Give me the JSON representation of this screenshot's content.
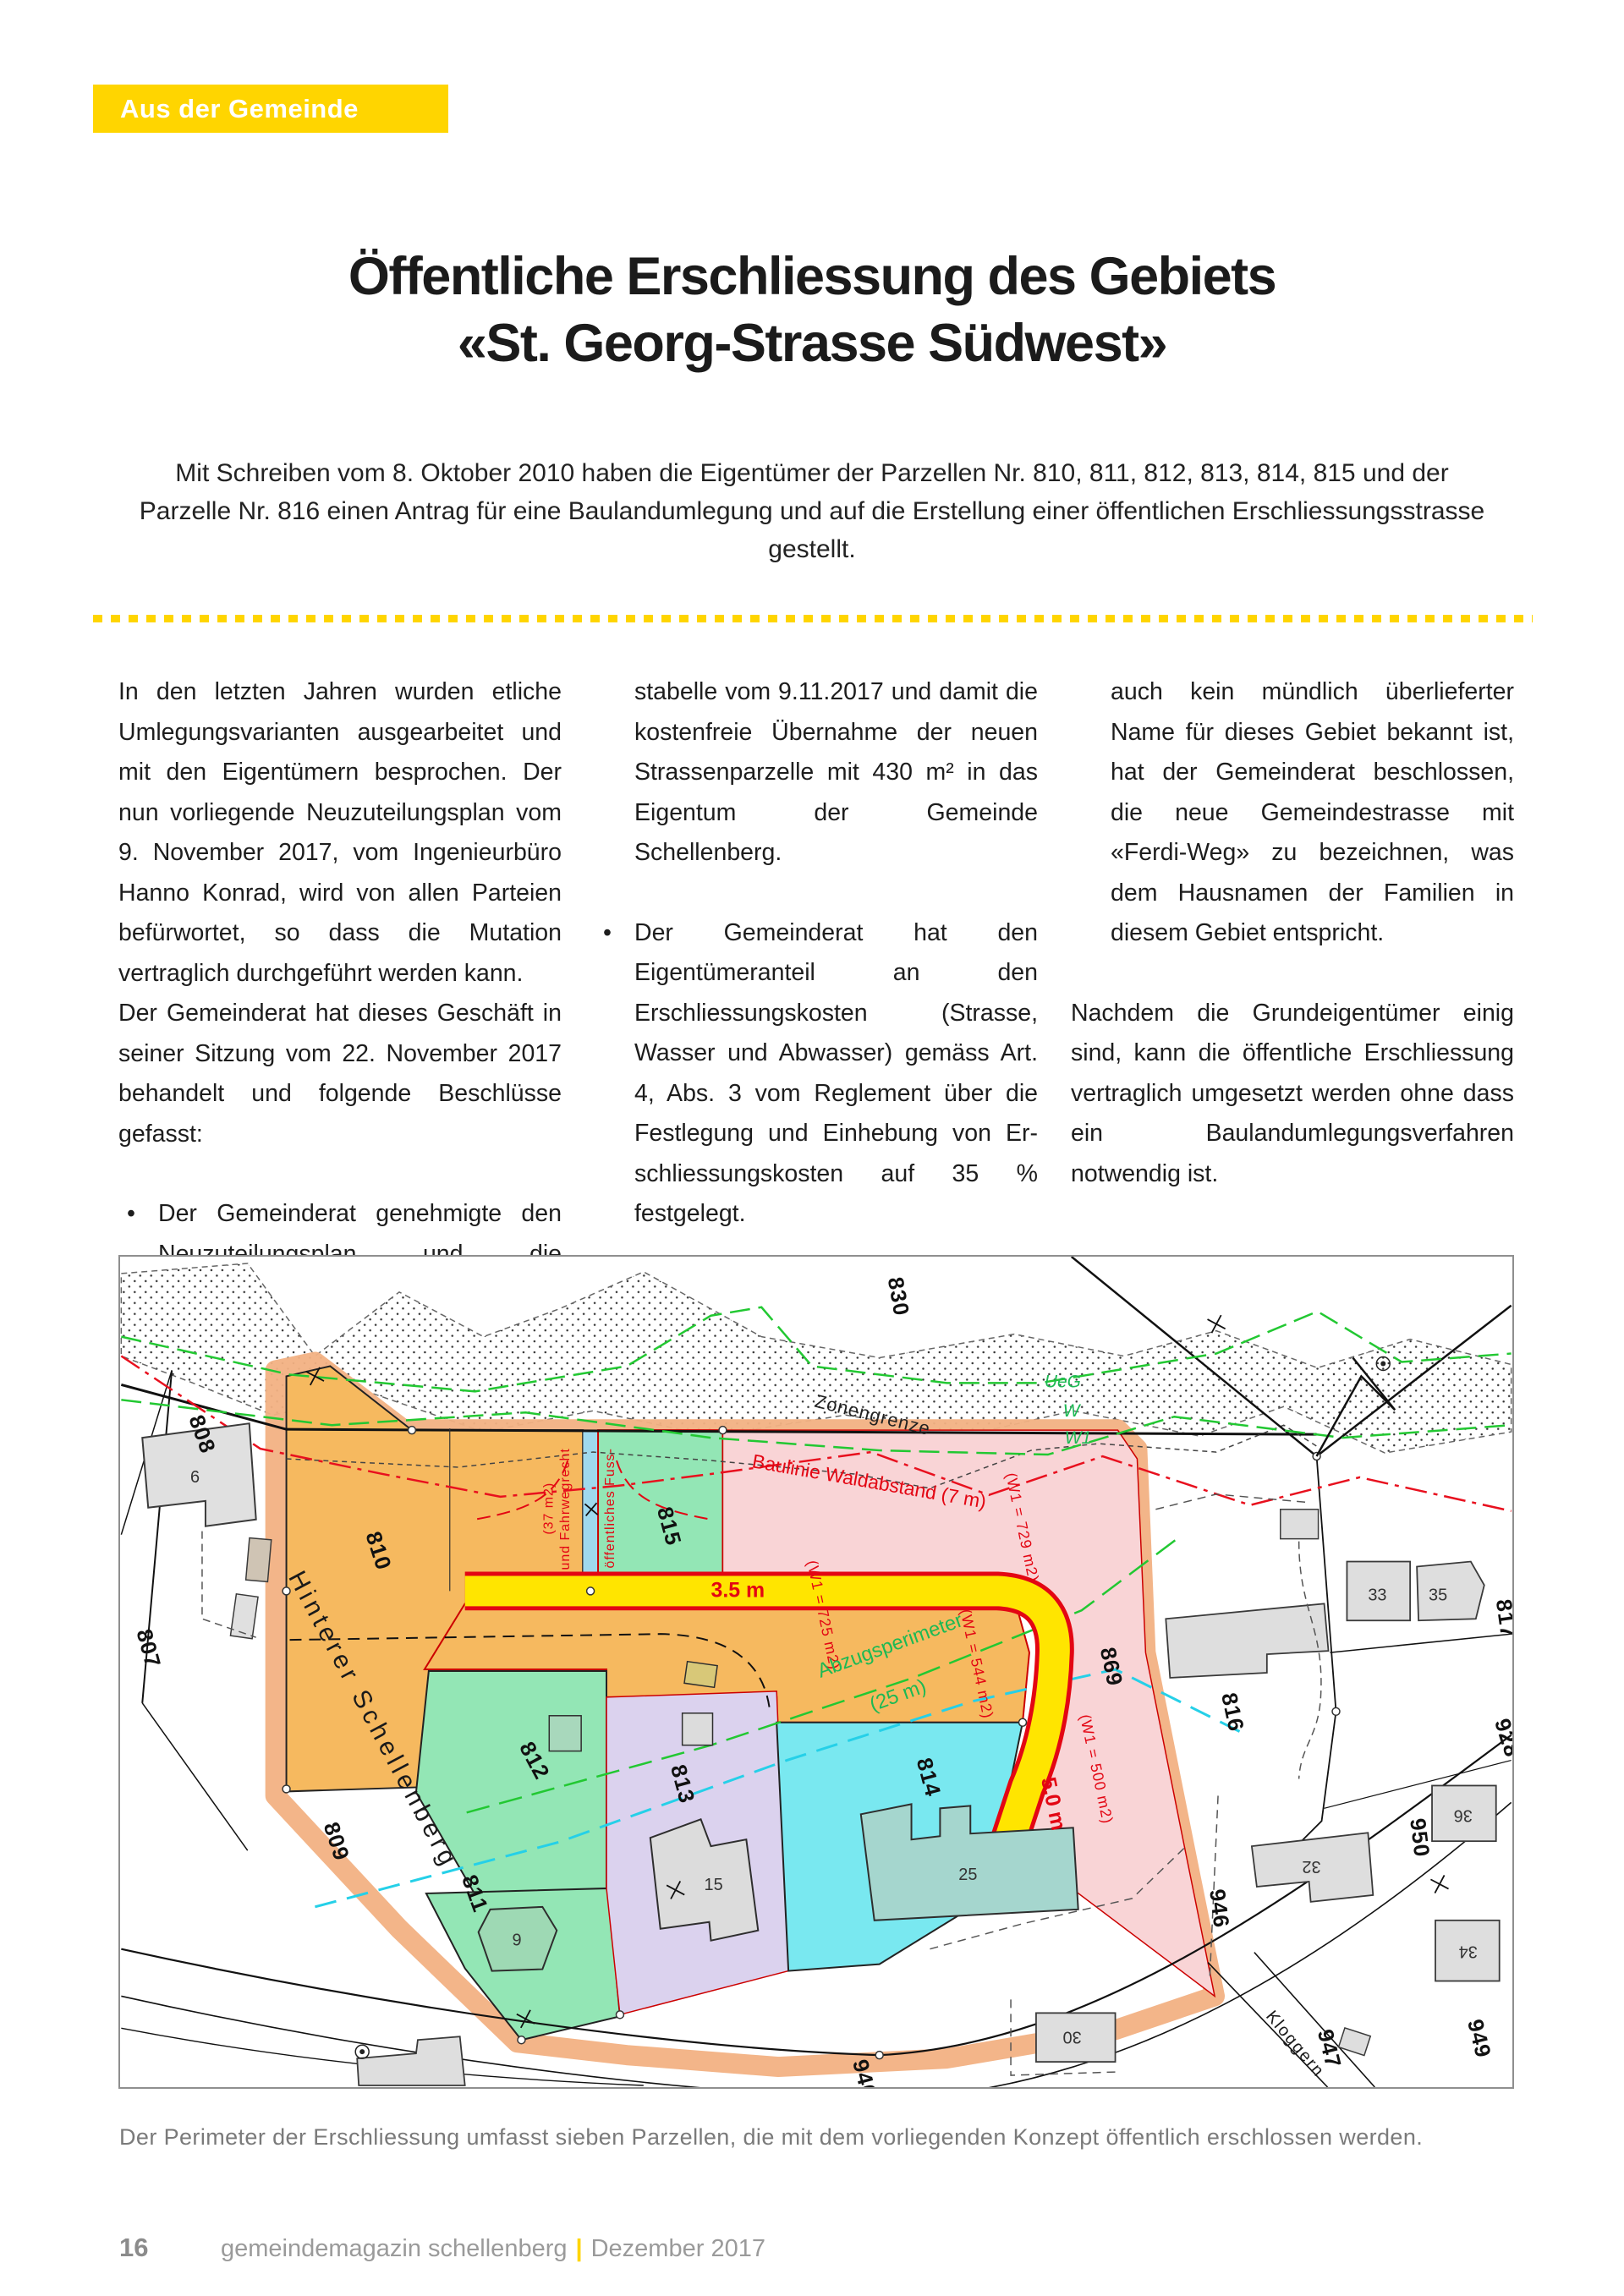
{
  "page": {
    "badge": "Aus der Gemeinde",
    "title_line1": "Öffentliche Erschliessung des Gebiets",
    "title_line2": "«St. Georg-Strasse Südwest»",
    "intro": "Mit Schreiben vom 8. Oktober 2010 haben die Eigentümer der Parzellen Nr. 810, 811, 812, 813, 814, 815 und der Parzelle Nr. 816 einen Antrag für eine Baulandumlegung und auf die Erstellung einer öffentlichen Erschliessungsstrasse gestellt.",
    "caption": "Der Perimeter der Erschliessung umfasst sieben Parzellen, die mit dem vorliegenden Konzept öffentlich erschlossen werden.",
    "footer": {
      "page_number": "16",
      "magazine": "gemeindemagazin schellenberg",
      "separator": "|",
      "issue": "Dezember 2017"
    }
  },
  "article": {
    "col1_para1": "In den letzten Jahren wurden etliche Umle­gungsvarianten ausgearbeitet und mit den Eigentümern besprochen. Der nun vorlie­gende Neuzuteilungsplan vom 9. November 2017, vom Ingenieurbüro Hanno Konrad, wird von allen Parteien befürwortet, so dass die Mutation vertraglich durchgeführt werden kann.",
    "col1_para2": "Der Gemeinderat hat dieses Geschäft in seiner Sitzung vom 22. November 2017 be­handelt und folgende Beschlüsse gefasst:",
    "col1_bullet1": "Der Gemeinderat genehmigte den Neu­zuteilungsplan und die Besitzstand-",
    "col2_cont": "stabelle vom 9.11.2017 und damit die kostenfreie Übernahme der neuen Strassenparzelle mit 430 m² in das Eigentum der Gemeinde Schellenberg.",
    "col2_bullet1": "Der Gemeinderat hat den Eigentümer­anteil an den Erschliessungskosten (Strasse, Wasser und Abwasser) ge­mäss Art. 4, Abs. 3 vom Reglement über die Festlegung und Einhebung von Er­schliessungskosten auf 35 % festgelegt.",
    "col2_bullet2": "Da in diesem Gebiet gemäss Flurnamen­karte kein Flurname vorhanden ist und",
    "col3_cont": "auch kein mündlich überlieferter Name für dieses Gebiet bekannt ist, hat der Gemeinderat beschlossen, die neue Gemeindestrasse mit «Ferdi-Weg» zu bezeichnen, was dem Hausnamen der Familien in diesem Gebiet entspricht.",
    "col3_para": "Nachdem die Grundeigentümer einig sind, kann die öffentliche Erschliessung ver­traglich umgesetzt werden ohne dass ein Baulandumlegungsverfahren notwendig ist."
  },
  "map": {
    "parcels": {
      "p807": "807",
      "p808": "808",
      "p809": "809",
      "p810": "810",
      "p811": "811",
      "p812": "812",
      "p813": "813",
      "p814": "814",
      "p815": "815",
      "p816": "816",
      "p817": "817",
      "p830": "830",
      "p869": "869",
      "p928": "928",
      "p940": "940",
      "p946": "946",
      "p947": "947",
      "p949": "949",
      "p950": "950"
    },
    "houses": {
      "h6": "6",
      "h9": "9",
      "h15": "15",
      "h25": "25",
      "h30": "30",
      "h32": "32",
      "h33": "33",
      "h34": "34",
      "h35": "35",
      "h36": "36"
    },
    "streets": {
      "hinterer_schellenberg": "Hinterer Schellenberg",
      "kloggern": "Kloggern"
    },
    "annotations": {
      "baulinie": "Baulinie Waldabstand (7 m)",
      "zonengrenze": "Zonengrenze",
      "ueg": "UeG",
      "w": "W",
      "w1": "W1",
      "abzugsperimeter_1": "Abzugsperimeter",
      "abzugsperimeter_2": "(25 m)",
      "road_width_horizontal": "3.5 m",
      "road_width_vertical": "5.0 m",
      "area_725": "(W1 = 725 m2)",
      "area_729": "(W1 = 729 m2)",
      "area_544": "(W1 = 544 m2)",
      "area_500": "(W1 = 500 m2)",
      "fussweg_1": "öffentliches Fuss-",
      "fussweg_2": "und Fahrwegrecht",
      "fussweg_3": "(37 m2)"
    },
    "colors": {
      "parcel_orange": "#F6B95F",
      "parcel_green": "#93E6B5",
      "parcel_pink": "#F9D4D6",
      "parcel_lavender": "#DBD2EE",
      "parcel_cyan": "#79E8F0",
      "footpath_blue": "#9FD9EE",
      "perimeter_salmon": "#F2B183",
      "road_yellow": "#FFE500",
      "road_red_border": "#E30613",
      "accent_yellow": "#FFD500"
    }
  }
}
